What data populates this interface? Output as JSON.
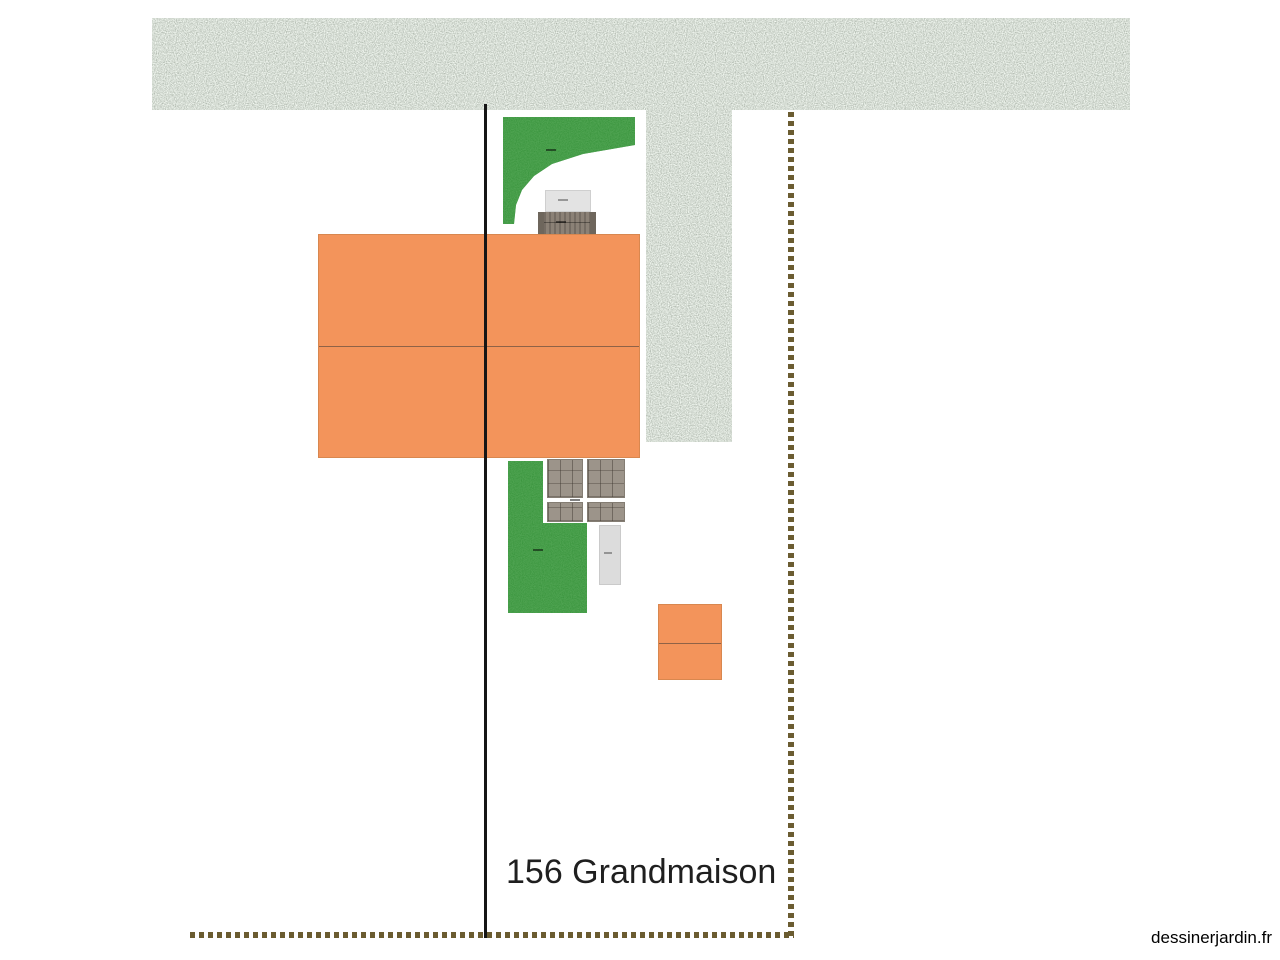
{
  "canvas": {
    "background": "#ffffff",
    "address_label": "156 Grandmaison",
    "watermark": "dessinerjardin.fr"
  },
  "palette": {
    "gravel_texture_base": "#a9b5a4",
    "gravel_texture_speckle": "#55604f",
    "lawn_green": "#1f7c22",
    "building_orange": "#f3945b",
    "building_ridge_line": "#8f6247",
    "paving_tile_gray": "#9c948a",
    "structure_light_gray": "#e3e3e3",
    "structure_taupe": "#8b8176",
    "boundary_dash_olive": "#6b5c31",
    "property_line_black": "#151515"
  },
  "objects": [
    {
      "name": "gravel-band-top",
      "type": "gravel-area",
      "color": "#a9b5a4"
    },
    {
      "name": "gravel-band-vertical",
      "type": "gravel-area",
      "color": "#a9b5a4"
    },
    {
      "name": "lawn-top",
      "type": "lawn",
      "color": "#1f7c22",
      "tiny_label_legible": false
    },
    {
      "name": "steps-light",
      "type": "structure",
      "color": "#e3e3e3",
      "tiny_label_legible": false
    },
    {
      "name": "steps-dark",
      "type": "structure",
      "color": "#8b8176",
      "tiny_label_legible": false
    },
    {
      "name": "building-main",
      "type": "building",
      "color": "#f3945b"
    },
    {
      "name": "paving-tiles",
      "type": "paving",
      "color": "#9c948a",
      "tiny_label_legible": false
    },
    {
      "name": "lawn-bottom",
      "type": "lawn",
      "color": "#1f7c22",
      "tiny_label_legible": false
    },
    {
      "name": "garage-small",
      "type": "structure",
      "color": "#dcdcdc",
      "tiny_label_legible": false
    },
    {
      "name": "building-annex",
      "type": "building",
      "color": "#f3945b"
    },
    {
      "name": "property-line",
      "type": "line",
      "color": "#151515"
    },
    {
      "name": "boundary-dash-vertical",
      "type": "dashed-boundary",
      "color": "#6b5c31"
    },
    {
      "name": "boundary-dash-horizontal",
      "type": "dashed-boundary",
      "color": "#6b5c31"
    }
  ]
}
